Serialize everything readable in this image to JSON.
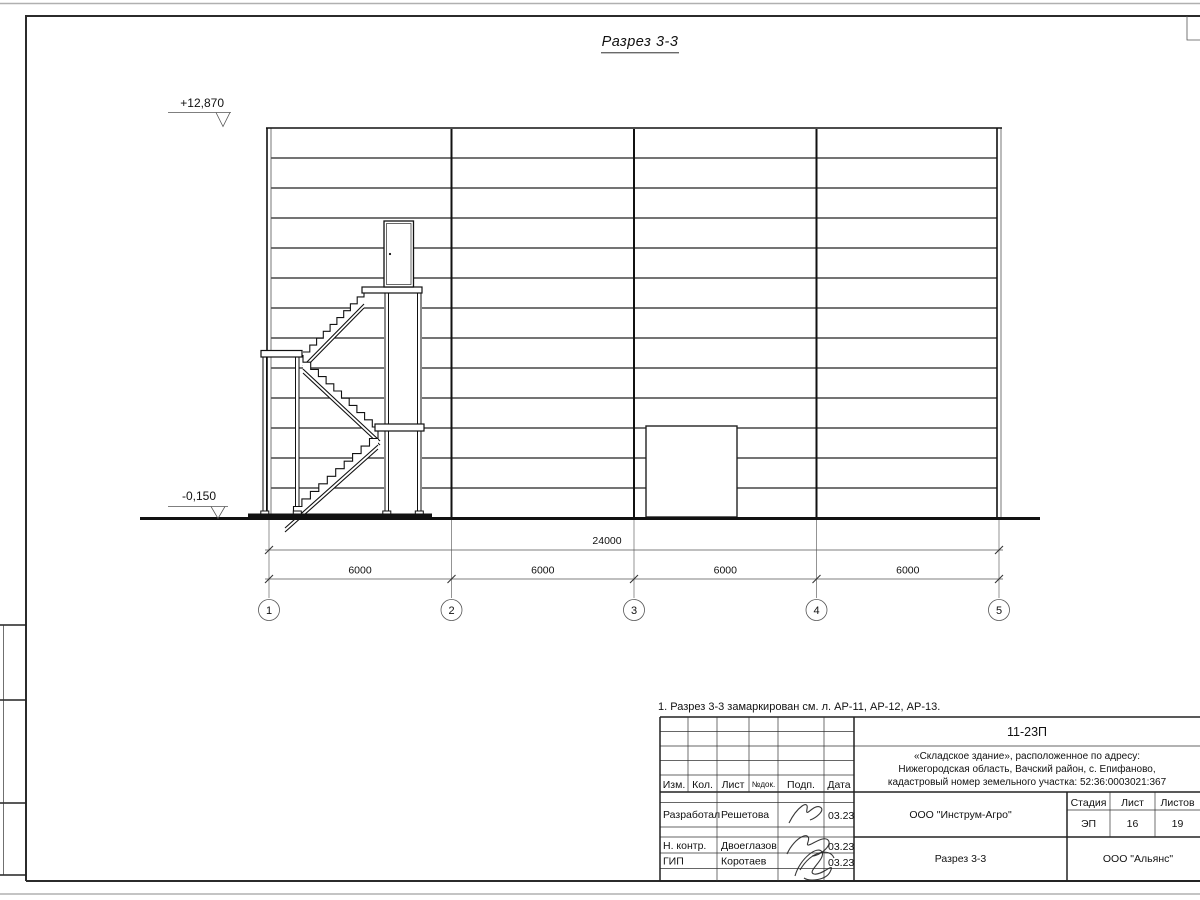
{
  "drawing": {
    "title": "Разрез 3-3",
    "elevation_top": "+12,870",
    "elevation_bottom": "-0,150",
    "dim_total": "24000",
    "dim_spans": [
      "6000",
      "6000",
      "6000",
      "6000"
    ],
    "axes": [
      "1",
      "2",
      "3",
      "4",
      "5"
    ]
  },
  "note": "1. Разрез 3-3 замаркирован см. л. АР-11, АР-12, АР-13.",
  "title_block": {
    "doc_number": "11-23П",
    "project_address": {
      "line1": "«Складское здание», расположенное по адресу:",
      "line2": "Нижегородская область, Вачский район, с. Епифаново,",
      "line3": "кадастровый номер земельного участка: 52:36:0003021:367"
    },
    "header_cols": {
      "izm": "Изм.",
      "kol": "Кол.",
      "list": "Лист",
      "doc_no": "№док.",
      "podp": "Подп.",
      "data": "Дата"
    },
    "signature_rows": [
      {
        "role": "Разработал",
        "name": "Решетова",
        "date": "03.23"
      },
      {
        "role": "Н. контр.",
        "name": "Двоеглазов",
        "date": "03.23"
      },
      {
        "role": "ГИП",
        "name": "Коротаев",
        "date": "03.23"
      }
    ],
    "developer_org": "ООО \"Инструм-Агро\"",
    "stage_label": "Стадия",
    "sheet_label": "Лист",
    "sheets_label": "Листов",
    "stage": "ЭП",
    "sheet_number": "16",
    "sheets_total": "19",
    "drawing_name": "Разрез 3-3",
    "contractor_org": "ООО \"Альянс\""
  }
}
